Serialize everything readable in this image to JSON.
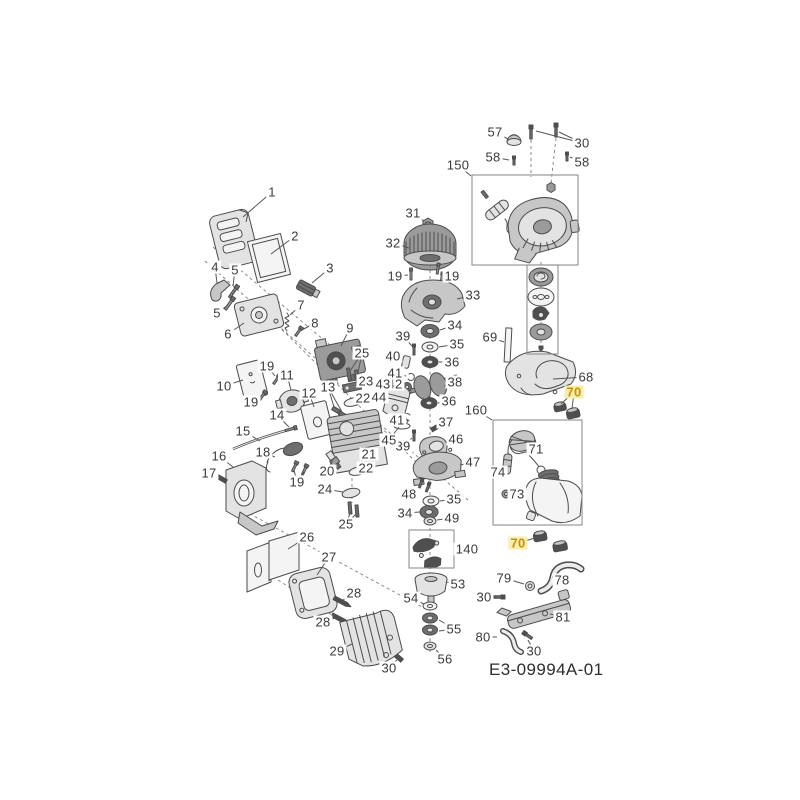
{
  "diagram": {
    "id_label": "E3-09994A-01",
    "colors": {
      "background": "#ffffff",
      "line": "#4c4c4c",
      "label": "#3a3a3a",
      "box": "#8f8f8f",
      "highlight_text": "#d18f00",
      "highlight_bg": "#f6efad"
    },
    "boxes": [
      {
        "name": "box-150-recoil-starter",
        "x": 472,
        "y": 175,
        "w": 106,
        "h": 90
      },
      {
        "name": "box-starter-pulley-stack",
        "x": 527,
        "y": 265,
        "w": 31,
        "h": 89
      },
      {
        "name": "box-160-fuel-tank",
        "x": 493,
        "y": 420,
        "w": 89,
        "h": 105
      },
      {
        "name": "box-140-clutch",
        "x": 409,
        "y": 530,
        "w": 45,
        "h": 38
      }
    ],
    "callouts": [
      {
        "label": "1",
        "x": 272,
        "y": 192,
        "tx": 243,
        "ty": 217
      },
      {
        "label": "2",
        "x": 295,
        "y": 236,
        "tx": 271,
        "ty": 254
      },
      {
        "label": "3",
        "x": 330,
        "y": 268,
        "tx": 312,
        "ty": 283
      },
      {
        "label": "4",
        "x": 215,
        "y": 267,
        "tx": 217,
        "ty": 283
      },
      {
        "label": "5",
        "x": 235,
        "y": 270,
        "tx": 233,
        "ty": 286
      },
      {
        "label": "5",
        "x": 217,
        "y": 313,
        "tx": 228,
        "ty": 305
      },
      {
        "label": "6",
        "x": 228,
        "y": 334,
        "tx": 244,
        "ty": 323
      },
      {
        "label": "7",
        "x": 301,
        "y": 305,
        "tx": 290,
        "ty": 315
      },
      {
        "label": "8",
        "x": 315,
        "y": 323,
        "tx": 300,
        "ty": 331
      },
      {
        "label": "9",
        "x": 350,
        "y": 328,
        "tx": 341,
        "ty": 346
      },
      {
        "label": "10",
        "x": 224,
        "y": 386,
        "tx": 243,
        "ty": 380
      },
      {
        "label": "11",
        "x": 287,
        "y": 375,
        "tx": 291,
        "ty": 390
      },
      {
        "label": "12",
        "x": 309,
        "y": 393,
        "tx": 314,
        "ty": 407
      },
      {
        "label": "13",
        "x": 328,
        "y": 387,
        "tx": 334,
        "ty": 407,
        "tx2": 342,
        "ty2": 412
      },
      {
        "label": "14",
        "x": 277,
        "y": 415,
        "tx": 289,
        "ty": 427
      },
      {
        "label": "15",
        "x": 243,
        "y": 431,
        "tx": 260,
        "ty": 441
      },
      {
        "label": "16",
        "x": 219,
        "y": 456,
        "tx": 233,
        "ty": 467
      },
      {
        "label": "17",
        "x": 209,
        "y": 473,
        "tx": 220,
        "ty": 478
      },
      {
        "label": "18",
        "x": 263,
        "y": 452,
        "tx": 275,
        "ty": 457
      },
      {
        "label": "19",
        "x": 267,
        "y": 366,
        "tx": 275,
        "ty": 376
      },
      {
        "label": "19",
        "x": 251,
        "y": 402,
        "tx": 261,
        "ty": 396
      },
      {
        "label": "19",
        "x": 297,
        "y": 482,
        "tx": 294,
        "ty": 470,
        "tx2": 304,
        "ty2": 472
      },
      {
        "label": "19",
        "x": 395,
        "y": 276,
        "tx": 408,
        "ty": 275
      },
      {
        "label": "19",
        "x": 452,
        "y": 276,
        "tx": 441,
        "ty": 273
      },
      {
        "label": "20",
        "x": 327,
        "y": 471,
        "tx": 333,
        "ty": 459
      },
      {
        "label": "21",
        "x": 369,
        "y": 454,
        "tx": 362,
        "ty": 447
      },
      {
        "label": "22",
        "x": 363,
        "y": 398,
        "tx": 354,
        "ty": 402
      },
      {
        "label": "22",
        "x": 366,
        "y": 468,
        "tx": 358,
        "ty": 470
      },
      {
        "label": "23",
        "x": 366,
        "y": 381,
        "tx": 355,
        "ty": 386
      },
      {
        "label": "24",
        "x": 325,
        "y": 489,
        "tx": 343,
        "ty": 492
      },
      {
        "label": "25",
        "x": 362,
        "y": 353,
        "tx": 350,
        "ty": 371,
        "tx2": 358,
        "ty2": 373
      },
      {
        "label": "25",
        "x": 346,
        "y": 524,
        "tx": 351,
        "ty": 511,
        "tx2": 357,
        "ty2": 513
      },
      {
        "label": "26",
        "x": 307,
        "y": 537,
        "tx": 288,
        "ty": 549
      },
      {
        "label": "27",
        "x": 329,
        "y": 557,
        "tx": 317,
        "ty": 575
      },
      {
        "label": "28",
        "x": 354,
        "y": 593,
        "tx": 343,
        "ty": 600
      },
      {
        "label": "28",
        "x": 323,
        "y": 622,
        "tx": 335,
        "ty": 618
      },
      {
        "label": "29",
        "x": 337,
        "y": 651,
        "tx": 352,
        "ty": 644
      },
      {
        "label": "30",
        "x": 389,
        "y": 668,
        "tx": 397,
        "ty": 660
      },
      {
        "label": "30",
        "x": 582,
        "y": 143,
        "tx": 559,
        "ty": 132,
        "tx2": 536,
        "ty2": 131
      },
      {
        "label": "30",
        "x": 484,
        "y": 597,
        "tx": 497,
        "ty": 597
      },
      {
        "label": "30",
        "x": 534,
        "y": 651,
        "tx": 528,
        "ty": 640
      },
      {
        "label": "31",
        "x": 413,
        "y": 213,
        "tx": 424,
        "ty": 221
      },
      {
        "label": "32",
        "x": 393,
        "y": 243,
        "tx": 409,
        "ty": 248
      },
      {
        "label": "33",
        "x": 473,
        "y": 295,
        "tx": 457,
        "ty": 299
      },
      {
        "label": "34",
        "x": 455,
        "y": 325,
        "tx": 440,
        "ty": 330
      },
      {
        "label": "34",
        "x": 405,
        "y": 513,
        "tx": 420,
        "ty": 512
      },
      {
        "label": "35",
        "x": 457,
        "y": 344,
        "tx": 439,
        "ty": 347
      },
      {
        "label": "35",
        "x": 454,
        "y": 499,
        "tx": 440,
        "ty": 501
      },
      {
        "label": "36",
        "x": 452,
        "y": 362,
        "tx": 439,
        "ty": 362
      },
      {
        "label": "36",
        "x": 449,
        "y": 401,
        "tx": 438,
        "ty": 403
      },
      {
        "label": "37",
        "x": 446,
        "y": 422,
        "tx": 437,
        "ty": 427
      },
      {
        "label": "38",
        "x": 455,
        "y": 382,
        "tx": 444,
        "ty": 386
      },
      {
        "label": "39",
        "x": 403,
        "y": 336,
        "tx": 412,
        "ty": 346
      },
      {
        "label": "39",
        "x": 403,
        "y": 446,
        "tx": 412,
        "ty": 438
      },
      {
        "label": "40",
        "x": 393,
        "y": 356,
        "tx": 403,
        "ty": 361
      },
      {
        "label": "41",
        "x": 395,
        "y": 373,
        "tx": 406,
        "ty": 376
      },
      {
        "label": "41",
        "x": 397,
        "y": 420,
        "tx": 407,
        "ty": 418
      },
      {
        "label": "42",
        "x": 395,
        "y": 384,
        "tx": 404,
        "ty": 387
      },
      {
        "label": "43",
        "x": 383,
        "y": 384,
        "tx": 394,
        "ty": 388
      },
      {
        "label": "44",
        "x": 379,
        "y": 397,
        "tx": 388,
        "ty": 400
      },
      {
        "label": "45",
        "x": 389,
        "y": 440,
        "tx": 399,
        "ty": 427
      },
      {
        "label": "46",
        "x": 456,
        "y": 439,
        "tx": 445,
        "ty": 442
      },
      {
        "label": "47",
        "x": 473,
        "y": 462,
        "tx": 460,
        "ty": 465
      },
      {
        "label": "48",
        "x": 409,
        "y": 494,
        "tx": 419,
        "ty": 487
      },
      {
        "label": "49",
        "x": 452,
        "y": 518,
        "tx": 437,
        "ty": 520
      },
      {
        "label": "53",
        "x": 458,
        "y": 584,
        "tx": 446,
        "ty": 582
      },
      {
        "label": "54",
        "x": 411,
        "y": 598,
        "tx": 424,
        "ty": 604
      },
      {
        "label": "55",
        "x": 454,
        "y": 629,
        "tx": 439,
        "ty": 620,
        "tx2": 439,
        "ty2": 631
      },
      {
        "label": "56",
        "x": 445,
        "y": 659,
        "tx": 436,
        "ty": 650
      },
      {
        "label": "57",
        "x": 495,
        "y": 132,
        "tx": 508,
        "ty": 139
      },
      {
        "label": "58",
        "x": 493,
        "y": 157,
        "tx": 509,
        "ty": 160
      },
      {
        "label": "58",
        "x": 582,
        "y": 162,
        "tx": 570,
        "ty": 157
      },
      {
        "label": "68",
        "x": 586,
        "y": 377,
        "tx": 553,
        "ty": 379
      },
      {
        "label": "69",
        "x": 490,
        "y": 337,
        "tx": 504,
        "ty": 342
      },
      {
        "label": "70",
        "x": 574,
        "y": 392,
        "tx": 561,
        "ty": 404,
        "tx2": 572,
        "ty2": 409,
        "hl": true
      },
      {
        "label": "70",
        "x": 518,
        "y": 543,
        "tx": 535,
        "ty": 538,
        "hl": true
      },
      {
        "label": "71",
        "x": 536,
        "y": 449,
        "tx": 527,
        "ty": 444
      },
      {
        "label": "73",
        "x": 517,
        "y": 494,
        "tx": 511,
        "ty": 494
      },
      {
        "label": "74",
        "x": 498,
        "y": 472,
        "tx": 505,
        "ty": 468
      },
      {
        "label": "78",
        "x": 562,
        "y": 580,
        "tx": 552,
        "ty": 577
      },
      {
        "label": "79",
        "x": 504,
        "y": 578,
        "tx": 524,
        "ty": 584
      },
      {
        "label": "80",
        "x": 483,
        "y": 637,
        "tx": 497,
        "ty": 637
      },
      {
        "label": "81",
        "x": 563,
        "y": 617,
        "tx": 550,
        "ty": 614
      },
      {
        "label": "140",
        "x": 467,
        "y": 549,
        "tx": 455,
        "ty": 549
      },
      {
        "label": "150",
        "x": 458,
        "y": 165,
        "tx": 471,
        "ty": 176
      },
      {
        "label": "160",
        "x": 476,
        "y": 410,
        "tx": 492,
        "ty": 420
      }
    ]
  }
}
